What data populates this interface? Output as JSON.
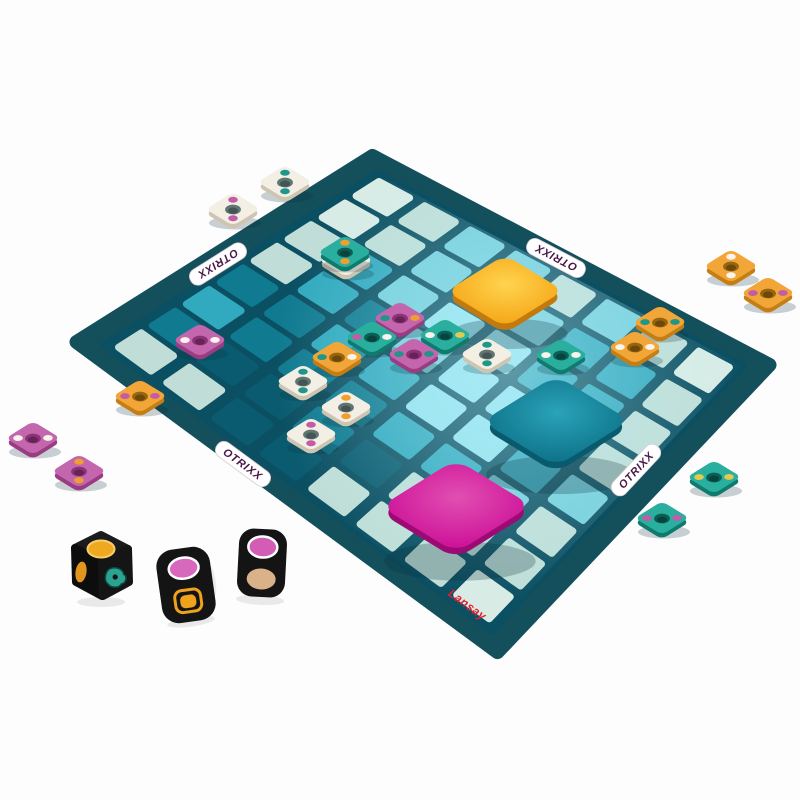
{
  "page": {
    "background": "#fdfdfe"
  },
  "branding": {
    "title": "OTRIXX",
    "title_color": "#4a1646",
    "publisher": "Lansay",
    "publisher_color": "#e41e2d"
  },
  "board": {
    "corners": {
      "left": [
        105,
        345
      ],
      "top": [
        377,
        174
      ],
      "right": [
        742,
        366
      ],
      "bottom": [
        492,
        630
      ]
    },
    "border_color": "#144f5c",
    "base_color": "#0b4f62",
    "cell_palette": {
      "0": "#0a5b70",
      "1": "#107a90",
      "2": "#31a9be",
      "3": "#74cfdc",
      "4": "#c0ded7",
      "5": "#d8ece5",
      "6": "#93e2ee"
    },
    "cells": [
      [
        4,
        1,
        2,
        1,
        4,
        4,
        5,
        5
      ],
      [
        4,
        0,
        1,
        1,
        2,
        2,
        4,
        4
      ],
      [
        0,
        0,
        1,
        2,
        1,
        3,
        3,
        3
      ],
      [
        0,
        1,
        1,
        2,
        3,
        6,
        3,
        3
      ],
      [
        4,
        0,
        2,
        6,
        6,
        6,
        3,
        4
      ],
      [
        4,
        4,
        2,
        6,
        6,
        2,
        2,
        3
      ],
      [
        4,
        4,
        3,
        2,
        3,
        2,
        2,
        4
      ],
      [
        5,
        4,
        4,
        3,
        4,
        4,
        4,
        5
      ]
    ]
  },
  "big_squares": [
    {
      "name": "orange",
      "x": 505,
      "y": 291,
      "size": 69,
      "color_center": "#ffd44f",
      "color_edge": "#f5a515",
      "side": "#c2790d"
    },
    {
      "name": "teal",
      "x": 556,
      "y": 421,
      "size": 87,
      "color_center": "#2aa3b8",
      "color_edge": "#0c7188",
      "side": "#0a5a6e"
    },
    {
      "name": "magenta",
      "x": 456,
      "y": 506,
      "size": 89,
      "color_center": "#e14fb2",
      "color_edge": "#cc0f97",
      "side": "#9c0b74"
    }
  ],
  "tile_style": {
    "surfaces": {
      "white": "#f3efe4",
      "orange": "#f3a638",
      "magenta": "#c466ad",
      "teal": "#2aaf9f"
    },
    "sides": {
      "white": "#cdc5b2",
      "orange": "#c57e13",
      "magenta": "#9a3c82",
      "teal": "#0f7a6e"
    },
    "holes": {
      "white": "#5f7673",
      "orange": "#96650f",
      "magenta": "#8c3377",
      "teal": "#0b5f56"
    },
    "dot_colors": {
      "white": "#f8f4ec",
      "teal": "#1f968a",
      "magenta": "#c25ca8",
      "orange": "#f09f2e",
      "yellow": "#e3c94f"
    }
  },
  "tiles": [
    {
      "x": 345,
      "y": 252,
      "surface": "teal",
      "dots": [
        "orange",
        "orange"
      ],
      "layout": "v",
      "under": "white"
    },
    {
      "x": 200,
      "y": 340,
      "surface": "magenta",
      "dots": [
        "white",
        "white"
      ],
      "layout": "h"
    },
    {
      "x": 140,
      "y": 396,
      "surface": "orange",
      "dots": [
        "magenta",
        "magenta"
      ],
      "layout": "h"
    },
    {
      "x": 400,
      "y": 318,
      "surface": "magenta",
      "dots": [
        "teal",
        "orange"
      ],
      "layout": "h"
    },
    {
      "x": 372,
      "y": 337,
      "surface": "teal",
      "dots": [
        "magenta",
        "white"
      ],
      "layout": "h"
    },
    {
      "x": 337,
      "y": 357,
      "surface": "orange",
      "dots": [
        "teal",
        "white"
      ],
      "layout": "h"
    },
    {
      "x": 414,
      "y": 354,
      "surface": "magenta",
      "dots": [
        "teal",
        "teal"
      ],
      "layout": "h"
    },
    {
      "x": 445,
      "y": 335,
      "surface": "teal",
      "dots": [
        "white",
        "yellow"
      ],
      "layout": "h"
    },
    {
      "x": 487,
      "y": 354,
      "surface": "white",
      "dots": [
        "teal",
        "teal"
      ],
      "layout": "v"
    },
    {
      "x": 561,
      "y": 355,
      "surface": "teal",
      "dots": [
        "white",
        "white"
      ],
      "layout": "h"
    },
    {
      "x": 303,
      "y": 381,
      "surface": "white",
      "dots": [
        "teal",
        "teal"
      ],
      "layout": "v"
    },
    {
      "x": 346,
      "y": 407,
      "surface": "white",
      "dots": [
        "orange",
        "orange"
      ],
      "layout": "v"
    },
    {
      "x": 311,
      "y": 434,
      "surface": "white",
      "dots": [
        "magenta",
        "magenta"
      ],
      "layout": "v"
    },
    {
      "x": 660,
      "y": 322,
      "surface": "orange",
      "dots": [
        "teal",
        "teal"
      ],
      "layout": "h"
    },
    {
      "x": 635,
      "y": 347,
      "surface": "orange",
      "dots": [
        "white",
        "white"
      ],
      "layout": "h"
    },
    {
      "x": 285,
      "y": 182,
      "surface": "white",
      "dots": [
        "teal",
        "teal"
      ],
      "layout": "v"
    },
    {
      "x": 233,
      "y": 209,
      "surface": "white",
      "dots": [
        "magenta",
        "magenta"
      ],
      "layout": "v"
    },
    {
      "x": 731,
      "y": 266,
      "surface": "orange",
      "dots": [
        "white",
        "white"
      ],
      "layout": "v"
    },
    {
      "x": 768,
      "y": 293,
      "surface": "orange",
      "dots": [
        "magenta",
        "magenta"
      ],
      "layout": "h"
    },
    {
      "x": 33,
      "y": 438,
      "surface": "magenta",
      "dots": [
        "white",
        "white"
      ],
      "layout": "h"
    },
    {
      "x": 79,
      "y": 471,
      "surface": "magenta",
      "dots": [
        "orange",
        "orange"
      ],
      "layout": "v"
    },
    {
      "x": 714,
      "y": 477,
      "surface": "teal",
      "dots": [
        "yellow",
        "yellow"
      ],
      "layout": "h"
    },
    {
      "x": 662,
      "y": 518,
      "surface": "teal",
      "dots": [
        "magenta",
        "magenta"
      ],
      "layout": "h"
    }
  ],
  "dice": [
    {
      "style": "cube",
      "x": 101,
      "y": 565,
      "body": "#141414",
      "top_oval": "#efa81f",
      "top_ring": "#f7cf69",
      "side_oval": "#e2951d",
      "glyph": "#2ba390",
      "glyph_dark": "#0c4a40"
    },
    {
      "style": "tilt",
      "x": 186,
      "y": 585,
      "rot": -8,
      "body": "#141414",
      "oval": "#d868bc",
      "ring": "#ffffff",
      "glyph": "#efa21c"
    },
    {
      "style": "front",
      "x": 262,
      "y": 563,
      "rot": 3,
      "body": "#141414",
      "oval_top": "#d35cb5",
      "ring": "#ffffff",
      "oval_bottom": "#d9b289"
    }
  ]
}
